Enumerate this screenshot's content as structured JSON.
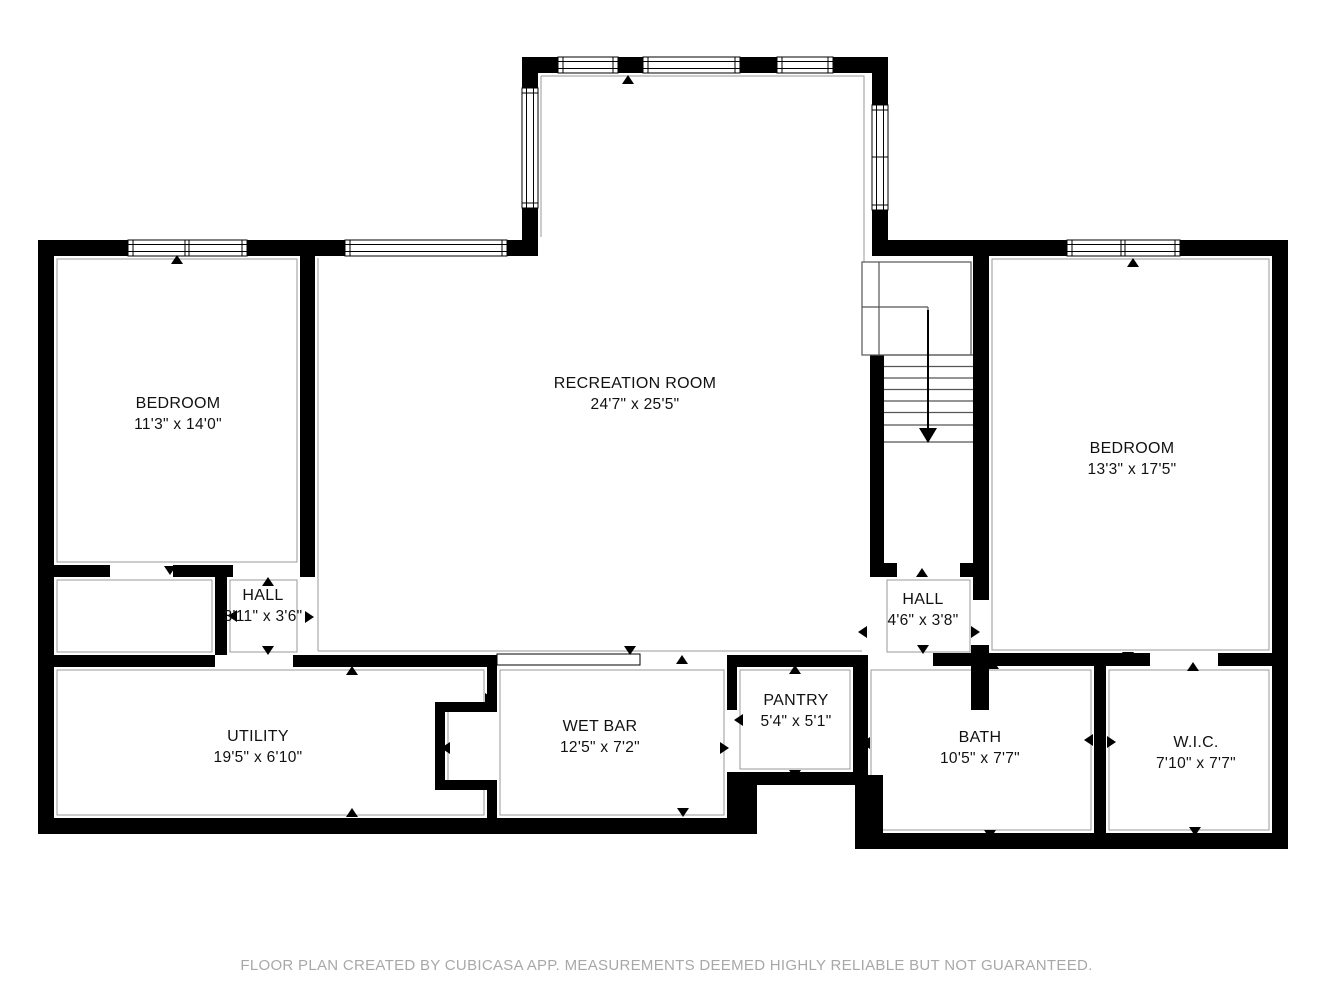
{
  "floor_plan": {
    "footer": "FLOOR PLAN CREATED BY CUBICASA APP. MEASUREMENTS DEEMED HIGHLY RELIABLE BUT NOT GUARANTEED.",
    "colors": {
      "wall": "#000000",
      "room_fill": "#ffffff",
      "room_outline": "#999999",
      "stair_line": "#555555",
      "label_text": "#111111",
      "footer_text": "#a8a8a8"
    },
    "rooms": [
      {
        "id": "recreation-room",
        "name": "RECREATION ROOM",
        "dims": "24'7\" x 25'5\""
      },
      {
        "id": "bedroom-left",
        "name": "BEDROOM",
        "dims": "11'3\" x 14'0\""
      },
      {
        "id": "bedroom-right",
        "name": "BEDROOM",
        "dims": "13'3\" x 17'5\""
      },
      {
        "id": "hall-left",
        "name": "HALL",
        "dims": "3'11\" x 3'6\""
      },
      {
        "id": "hall-right",
        "name": "HALL",
        "dims": "4'6\" x 3'8\""
      },
      {
        "id": "utility",
        "name": "UTILITY",
        "dims": "19'5\" x 6'10\""
      },
      {
        "id": "wet-bar",
        "name": "WET BAR",
        "dims": "12'5\" x 7'2\""
      },
      {
        "id": "pantry",
        "name": "PANTRY",
        "dims": "5'4\" x 5'1\""
      },
      {
        "id": "bath",
        "name": "BATH",
        "dims": "10'5\" x 7'7\""
      },
      {
        "id": "wic",
        "name": "W.I.C.",
        "dims": "7'10\" x 7'7\""
      }
    ]
  }
}
